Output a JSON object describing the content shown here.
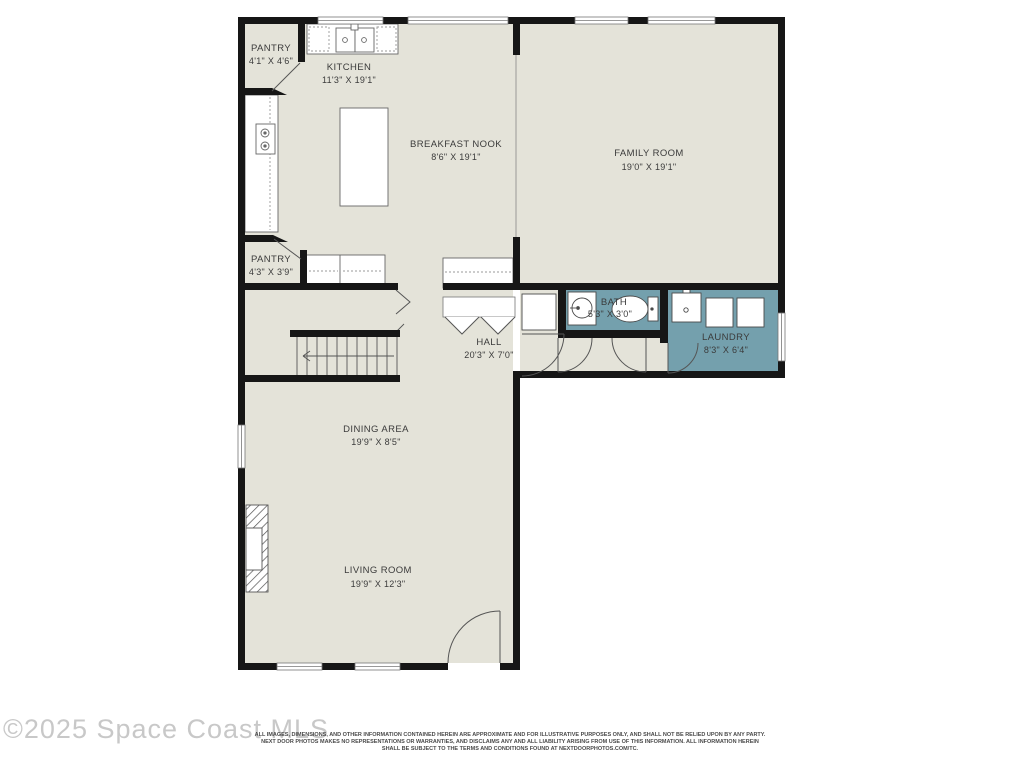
{
  "page": {
    "type": "residential-floor-plan"
  },
  "colors": {
    "floor": "#e4e3d9",
    "wet_room": "#74a0ad",
    "wall": "#161616",
    "fixture_stroke": "#5a5a5a",
    "label_text": "#3b3b3b",
    "watermark_text": "#c8c8c8",
    "disclaimer_text": "#4a4a4a"
  },
  "rooms": [
    {
      "id": "pantry-upper",
      "name": "PANTRY",
      "dims": "4'1\" X 4'6\""
    },
    {
      "id": "kitchen",
      "name": "KITCHEN",
      "dims": "11'3\" X 19'1\""
    },
    {
      "id": "breakfast-nook",
      "name": "BREAKFAST NOOK",
      "dims": "8'6\" X 19'1\""
    },
    {
      "id": "family-room",
      "name": "FAMILY ROOM",
      "dims": "19'0\" X 19'1\""
    },
    {
      "id": "pantry-lower",
      "name": "PANTRY",
      "dims": "4'3\" X 3'9\""
    },
    {
      "id": "bath",
      "name": "BATH",
      "dims": "5'3\" X 3'0\""
    },
    {
      "id": "laundry",
      "name": "LAUNDRY",
      "dims": "8'3\" X 6'4\""
    },
    {
      "id": "hall",
      "name": "HALL",
      "dims": "20'3\" X 7'0\""
    },
    {
      "id": "dining-area",
      "name": "DINING AREA",
      "dims": "19'9\" X 8'5\""
    },
    {
      "id": "living-room",
      "name": "LIVING ROOM",
      "dims": "19'9\" X 12'3\""
    }
  ],
  "fixtures": [
    "kitchen-sink",
    "cooktop",
    "kitchen-island",
    "counters",
    "pantry-doors",
    "bathroom-pedestal-sink",
    "toilet",
    "utility-sink",
    "washer",
    "dryer",
    "fireplace",
    "staircase",
    "closet-bifold-doors",
    "entry-door",
    "windows"
  ],
  "footer": {
    "watermark": "©2025 Space Coast MLS",
    "disclaimer_line1": "ALL IMAGES, DIMENSIONS, AND OTHER INFORMATION CONTAINED HEREIN ARE APPROXIMATE AND FOR ILLUSTRATIVE PURPOSES ONLY, AND SHALL NOT BE RELIED UPON BY ANY PARTY.",
    "disclaimer_line2": "NEXT DOOR PHOTOS MAKES NO REPRESENTATIONS OR WARRANTIES, AND DISCLAIMS ANY AND ALL LIABILITY ARISING FROM USE OF THIS INFORMATION. ALL INFORMATION HEREIN",
    "disclaimer_line3": "SHALL BE SUBJECT TO THE TERMS AND CONDITIONS FOUND AT NEXTDOORPHOTOS.COM/TC."
  }
}
